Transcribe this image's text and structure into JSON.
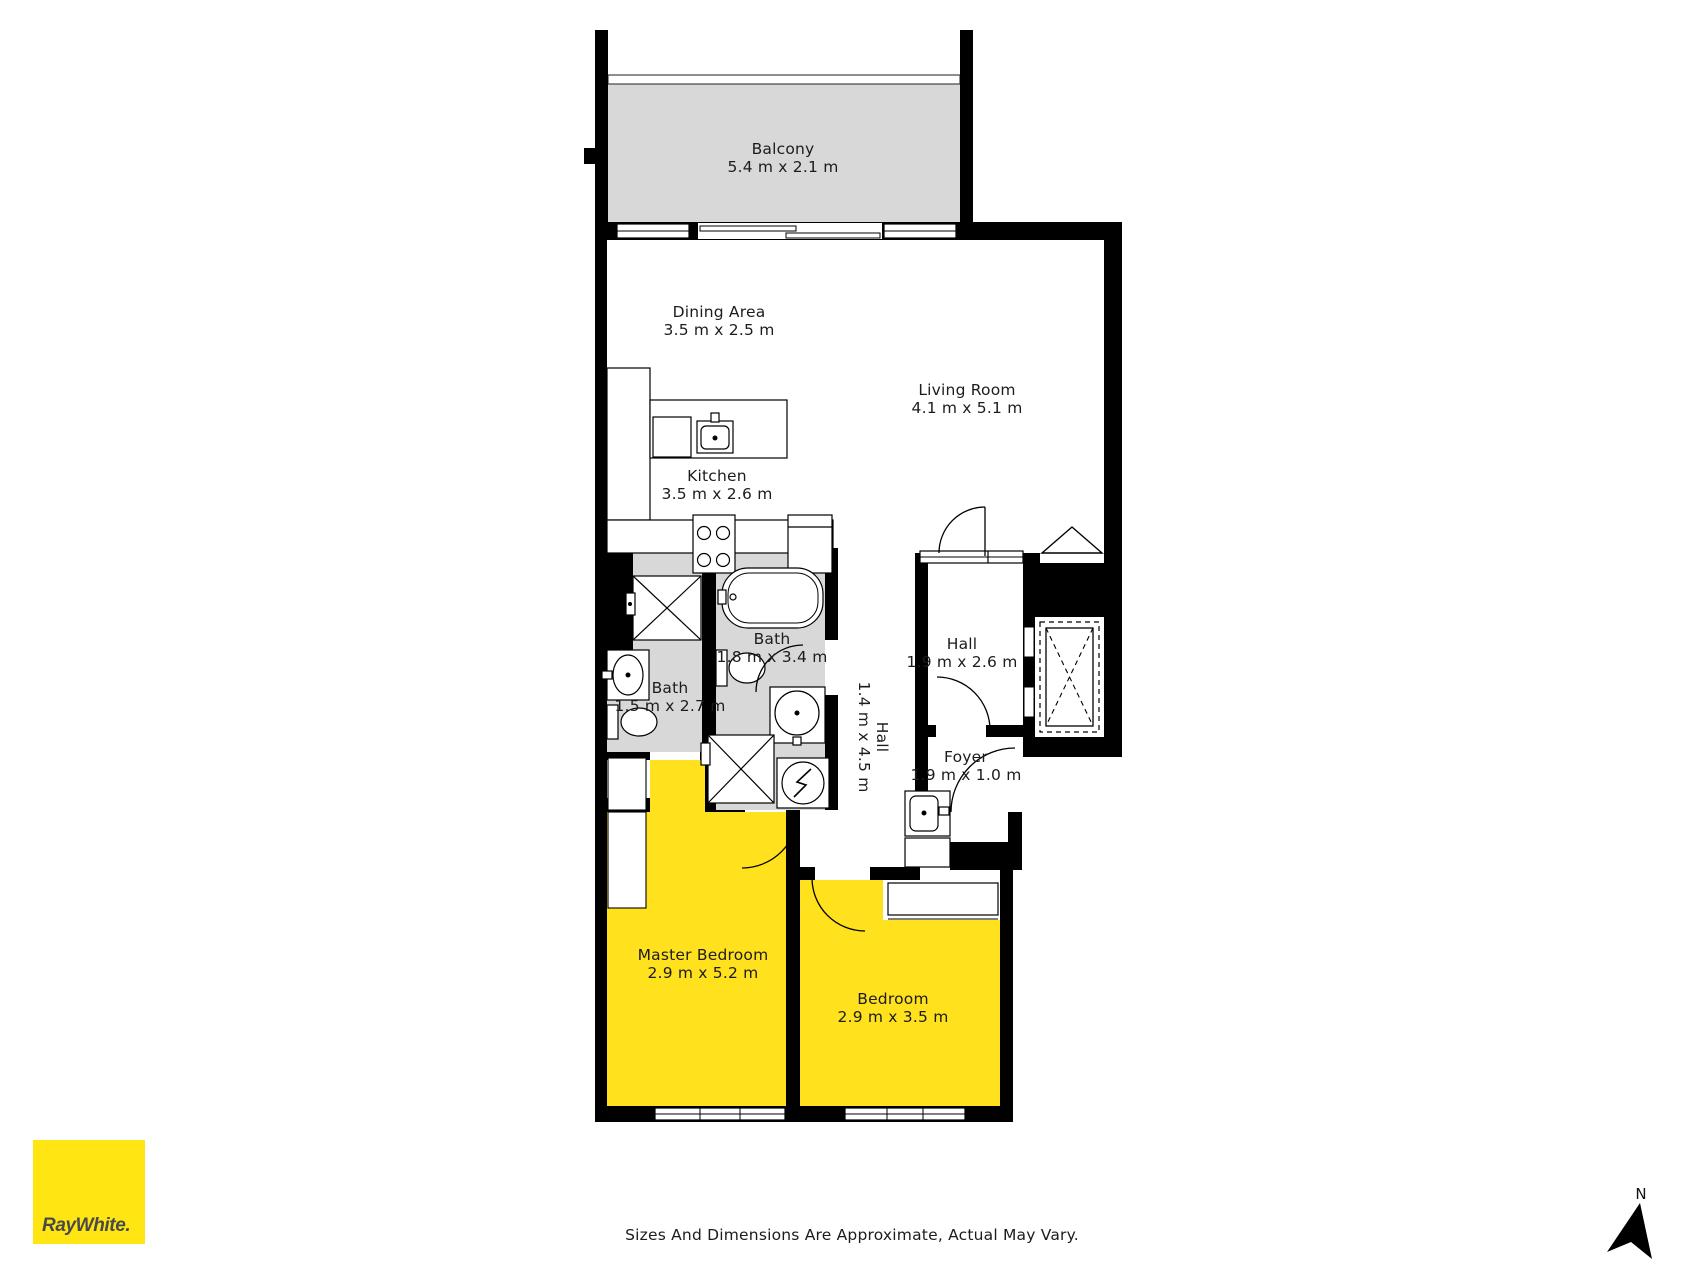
{
  "rooms": {
    "balcony": {
      "name": "Balcony",
      "dims": "5.4 m x 2.1 m"
    },
    "dining": {
      "name": "Dining Area",
      "dims": "3.5 m x 2.5 m"
    },
    "living": {
      "name": "Living Room",
      "dims": "4.1 m x 5.1 m"
    },
    "kitchen": {
      "name": "Kitchen",
      "dims": "3.5 m x 2.6 m"
    },
    "bath_big": {
      "name": "Bath",
      "dims": "1.8 m x 3.4 m"
    },
    "bath_small": {
      "name": "Bath",
      "dims": "1.5 m x 2.7 m"
    },
    "hall_upper": {
      "name": "Hall",
      "dims": "1.9 m x 2.6 m"
    },
    "hall_corridor": {
      "name": "Hall",
      "dims": "1.4 m x 4.5 m"
    },
    "foyer": {
      "name": "Foyer",
      "dims": "1.9 m x 1.0 m"
    },
    "master": {
      "name": "Master Bedroom",
      "dims": "2.9 m x 5.2 m"
    },
    "bedroom": {
      "name": "Bedroom",
      "dims": "2.9 m x 3.5 m"
    }
  },
  "footer": {
    "disclaimer": "Sizes And Dimensions Are Approximate, Actual May Vary."
  },
  "branding": {
    "logo_text": "RayWhite."
  },
  "compass": {
    "north_label": "N"
  },
  "colors": {
    "room_yellow": "#ffe11e",
    "floor_gray": "#d8d8d8",
    "wall_black": "#000000",
    "logo_yellow": "#ffe512",
    "logo_gray": "#4a4a4a"
  }
}
